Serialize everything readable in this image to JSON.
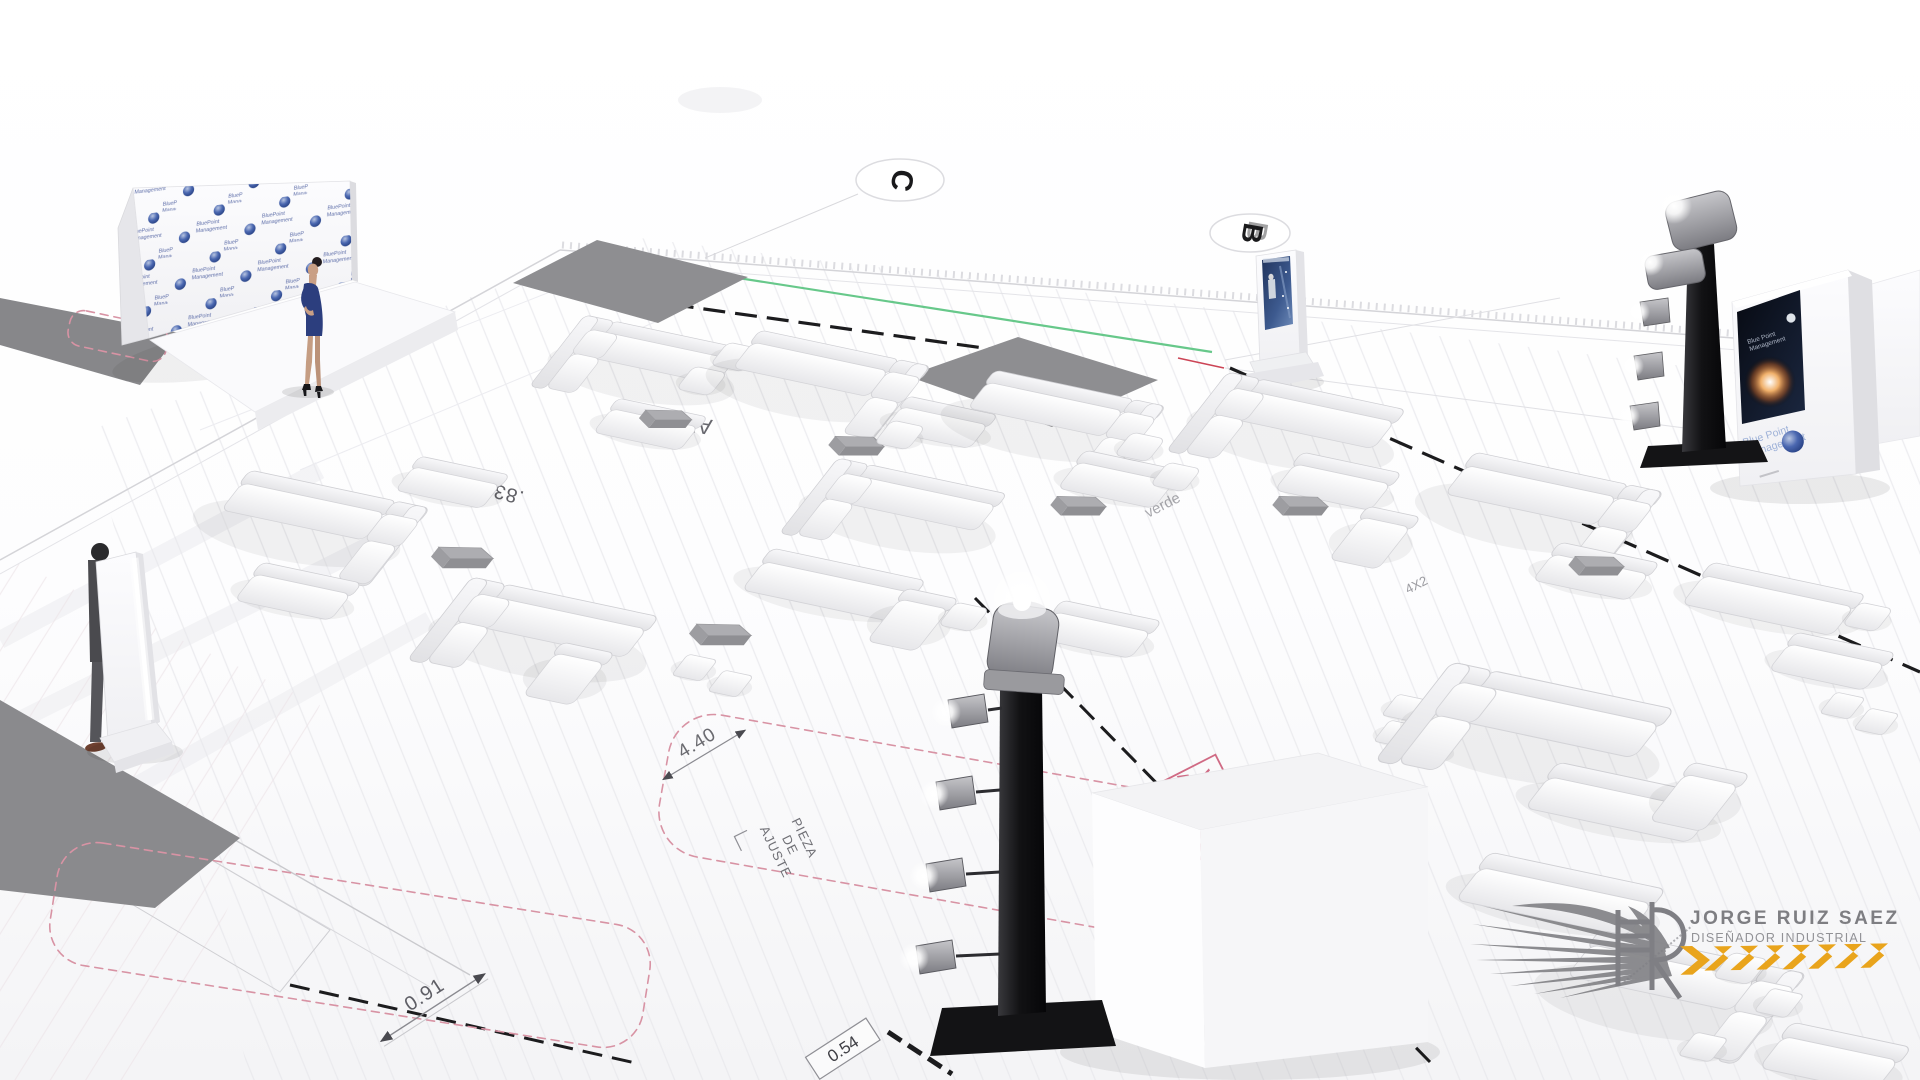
{
  "branding": {
    "backdrop_logo": {
      "line1": "BluePoint",
      "line2": "Management"
    },
    "media_wall_brand": {
      "line1": "Blue Point",
      "line2": "Management"
    },
    "media_screen_caption": {
      "line1": "Blue Point",
      "line2": "Management"
    }
  },
  "watermark": {
    "name": "JORGE RUIZ SAEZ",
    "subtitle": "DISEÑADOR INDUSTRIAL"
  },
  "plan": {
    "markers": {
      "c": "C",
      "b": "B"
    },
    "annotations": {
      "dim_long": "4.40",
      "dim_short": "0.91",
      "dim_box": "0.54",
      "pieza_l1": "PIEZA",
      "pieza_l2": "DE",
      "pieza_l3": "AJUSTE",
      "stamp_l1": "VER PLANO",
      "stamp_l2": "ALBAÑILERIA",
      "area_label": ".83M2",
      "grid_af": "AF",
      "note_verde": "verde",
      "note_str": "STR",
      "note_4x2": "4X2"
    }
  },
  "colors": {
    "sphere_blue": "#27418c",
    "logo_text_blue": "#5d6da8",
    "annotation_pink": "#d06a84",
    "cloud_pink": "#d893a4",
    "chevron_orange": "#E9A41C",
    "carpet_gray": "#8e8e91",
    "tower_black": "#121214",
    "green_line": "#57c27d"
  }
}
